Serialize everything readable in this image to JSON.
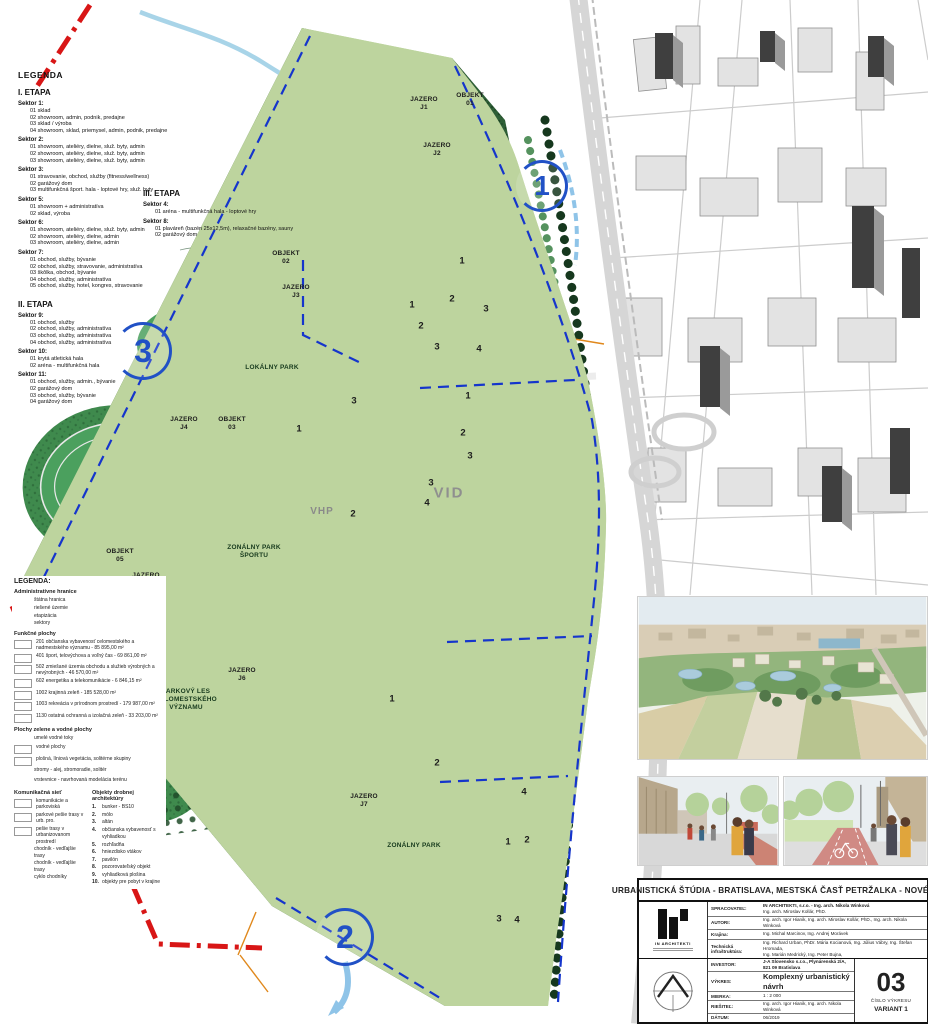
{
  "legend_stage1": {
    "title": "LEGENDA",
    "stage": "I. ETAPA",
    "sectors": [
      {
        "name": "Sektor 1:",
        "items": [
          "01 sklad",
          "02 showroom, admin, podnik, predajne",
          "03 sklad / výroba",
          "04 showroom, sklad, priemysel, admin, podnik, predajne"
        ]
      },
      {
        "name": "Sektor 2:",
        "items": [
          "01 showroom, ateliéry, dielne, služ. byty, admin",
          "02 showroom, ateliéry, dielne, služ. byty, admin",
          "03 showroom, ateliéry, dielne, služ. byty, admin"
        ]
      },
      {
        "name": "Sektor 3:",
        "items": [
          "01 stravovanie, obchod, služby (fitness/wellness)",
          "02 garážový dom",
          "03 multifunkčná šport. hala - loptové hry, služ. byty"
        ]
      },
      {
        "name": "Sektor 5:",
        "items": [
          "01 showroom + administratíva",
          "02 sklad, výroba"
        ]
      },
      {
        "name": "Sektor 6:",
        "items": [
          "01 showroom, ateliéry, dielne, služ. byty, admin",
          "02 showroom, ateliéry, dielne, admin",
          "03 showroom, ateliéry, dielne, admin"
        ]
      },
      {
        "name": "Sektor 7:",
        "items": [
          "01 obchod, služby, bývanie",
          "02 obchod, služby, stravovanie, administratíva",
          "03 škôlka, obchod, bývanie",
          "04 obchod, služby, administratíva",
          "05 obchod, služby, hotel, kongres, stravovanie"
        ]
      }
    ]
  },
  "legend_stage2": {
    "stage": "II. ETAPA",
    "sectors": [
      {
        "name": "Sektor 9:",
        "items": [
          "01 obchod, služby",
          "02 obchod, služby, administratíva",
          "03 obchod, služby, administratíva",
          "04 obchod, služby, administratíva"
        ]
      },
      {
        "name": "Sektor 10:",
        "items": [
          "01 krytá atletická hala",
          "02 aréna - multifunkčná hala"
        ]
      },
      {
        "name": "Sektor 11:",
        "items": [
          "01 obchod, služby, admin., bývanie",
          "02 garážový dom",
          "03 obchod, služby, bývanie",
          "04 garážový dom"
        ]
      }
    ]
  },
  "legend_stage3": {
    "stage": "III. ETAPA",
    "sectors": [
      {
        "name": "Sektor 4:",
        "items": [
          "01 aréna - multifunkčná hala - loptové hry"
        ]
      },
      {
        "name": "Sektor 8:",
        "items": [
          "01 plaváreň (bazén 25x12,5m), relaxačné bazény, sauny",
          "02 garážový dom"
        ]
      }
    ]
  },
  "map_legend": {
    "title": "LEGENDA:",
    "admin_title": "Administratívne hranice",
    "admin_items": [
      {
        "label": "štátna hranica"
      },
      {
        "label": "riešené územie"
      },
      {
        "label": "etapizácia"
      },
      {
        "label": "sektory"
      }
    ],
    "functional_title": "Funkčné plochy",
    "functional_items": [
      {
        "label": "201 občianska vybavenosť celomestského a nadmestského významu - 85 895,00 m²"
      },
      {
        "label": "401 šport, telovýchova a voľný čas - 69 861,00 m²"
      },
      {
        "label": "502 zmiešané územia obchodu a služieb výrobných a nevýrobných - 46 570,00 m²"
      },
      {
        "label": "602 energetika a telekomunikácie - 6 846,15 m²"
      },
      {
        "label": "1002 krajinná zeleň - 185 528,00 m²"
      },
      {
        "label": "1003 rekreácia v prírodnom prostredí - 179 987,00 m²"
      },
      {
        "label": "1130 ostatná ochranná a izolačná zeleň - 33 203,00 m²"
      }
    ],
    "green_title": "Plochy zelene a vodné plochy",
    "green_items": [
      {
        "label": "umelé vodné toky"
      },
      {
        "label": "vodné plochy"
      },
      {
        "label": "plošná, líniová vegetácia, solitérne skupiny"
      },
      {
        "label": "stromy - alej, stromoradie, solitér"
      },
      {
        "label": "vrstevnice - navrhovaná modelácia terénu"
      }
    ],
    "transport_title": "Komunikačná sieť",
    "transport_items": [
      {
        "label": "komunikácie a parkoviská"
      },
      {
        "label": "parkové pešie trasy v urb. pro."
      },
      {
        "label": "pešie trasy v urbanizovanom prostredí"
      },
      {
        "label": "chodník - vedľajšie trasy"
      },
      {
        "label": "chodník - vedľajšie trasy"
      },
      {
        "label": "cyklo chodníky"
      }
    ],
    "objects_title": "Objekty drobnej architektúry",
    "objects_items": [
      {
        "num": "1.",
        "label": "bunker - BS10"
      },
      {
        "num": "2.",
        "label": "mólo"
      },
      {
        "num": "3.",
        "label": "altán"
      },
      {
        "num": "4.",
        "label": "občianska vybavenosť s vyhliadkou"
      },
      {
        "num": "5.",
        "label": "rozhľadňa"
      },
      {
        "num": "6.",
        "label": "hniezdisko vtákov"
      },
      {
        "num": "7.",
        "label": "pavilón"
      },
      {
        "num": "8.",
        "label": "pozorovateľský objekt"
      },
      {
        "num": "9.",
        "label": "vyhliadková plošina"
      },
      {
        "num": "10.",
        "label": "objekty pre pobyt v krajine"
      }
    ]
  },
  "map": {
    "labels": {
      "j1": "JAZERO\nJ1",
      "o1": "OBJEKT\n01",
      "j2": "JAZERO\nJ2",
      "o2": "OBJEKT\n02",
      "j3": "JAZERO\nJ3",
      "lokalny": "LOKÁLNY PARK",
      "j4": "JAZERO\nJ4",
      "o3": "OBJEKT\n03",
      "o5": "OBJEKT\n05",
      "j5": "JAZERO\nJ5",
      "j6": "JAZERO\nJ6",
      "parkovy": "PARKOVÝ LES\nCELOMESTSKÉHO\nVÝZNAMU",
      "j7": "JAZERO\nJ7",
      "zps": "ZONÁLNY PARK\nŠPORTU",
      "zp": "ZONÁLNY PARK",
      "vhp": "VHP",
      "vid": "VID"
    },
    "badges": {
      "b1": "1",
      "b2": "2",
      "b3": "3"
    },
    "nums": [
      "1",
      "2",
      "1",
      "3",
      "2",
      "3",
      "4",
      "1",
      "2",
      "3",
      "3",
      "1",
      "2",
      "1",
      "2",
      "3",
      "4",
      "4",
      "1",
      "2",
      "3",
      "4"
    ]
  },
  "colors": {
    "state_border": "#d81616",
    "solved_area": "#e82020",
    "stage_line": "#1535cc",
    "forest": "#2e5f36",
    "meadow": "#4ba05e",
    "water": "#b8dcec",
    "stage1_building": "#f2aebc",
    "stage2_building": "#f7ec3e",
    "stage3_building": "#e02020"
  },
  "title_block": {
    "project_title": "URBANISTICKÁ ŠTÚDIA - BRATISLAVA, MESTSKÁ ČASŤ PETRŽALKA - NOVÉ POLE",
    "logo_name": "IN ARCHITEKTI",
    "rows": {
      "spracovatel_label": "SPRACOVATEĽ:",
      "spracovatel_1": "IN ARCHITEKTI, s.r.o. - Ing. arch. Nikola Winková",
      "spracovatel_2": "Ing. arch. Miroslav Kollár, PhD.",
      "autori_label": "AUTORI:",
      "autori": "Ing. arch. Igor Hianik, Ing. arch. Miroslav Kollár, PhD., Ing. arch. Nikola Winková",
      "krajina_label": "Krajina:",
      "krajina": "Ing. Michal Marcinov, Ing. Andrej Morávek",
      "tech_label": "Technická infraštruktúra:",
      "tech_1": "Ing. Richard Urban, PhDr. Mária Kocianová, Ing. Július Vábry, Ing. Štefan Hromada,",
      "tech_2": "Ing. Marián Medrický, Ing. Peter Bujna,",
      "investor_label": "INVESTOR:",
      "investor": "J-A Slovensko s.r.o., Plynárenská 2/A, 821 09 Bratislava",
      "vykres_label": "VÝKRES:",
      "vykres": "Komplexný urbanistický návrh",
      "mierka_label": "MIERKA:",
      "mierka": "1 : 2 000",
      "riesitel_label": "RIEŠITEĽ:",
      "riesitel": "Ing. arch. Igor Hianik, Ing. arch. Nikola Winková",
      "datum_label": "DÁTUM:",
      "datum": "06/2019"
    },
    "number": "03",
    "number_label": "ČÍSLO VÝKRESU",
    "variant": "VARIANT 1"
  }
}
